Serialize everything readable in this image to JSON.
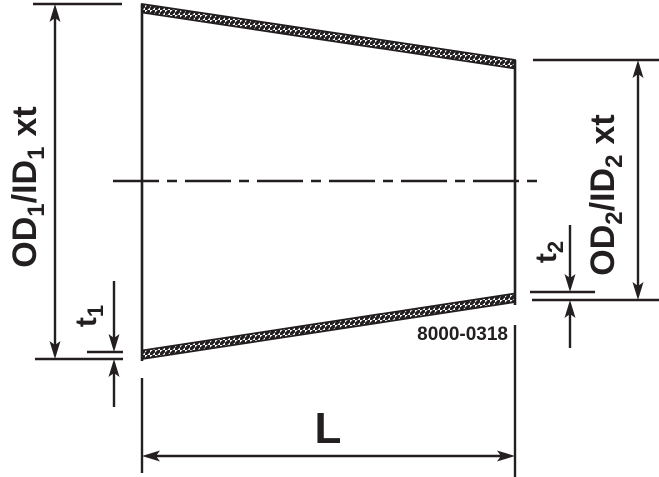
{
  "diagram": {
    "drawing_number": "8000-0318",
    "colors": {
      "line": "#231f20",
      "background": "#ffffff"
    },
    "labels": {
      "left_diameter": {
        "p1": "OD",
        "sub1": "1",
        "p2": "/ID",
        "sub2": "1",
        "p3": "xt"
      },
      "right_diameter": {
        "p1": "OD",
        "sub1": "2",
        "p2": "/ID",
        "sub2": "2",
        "p3": "xt"
      },
      "left_thickness": {
        "p1": "t",
        "sub1": "1"
      },
      "right_thickness": {
        "p1": "t",
        "sub1": "2"
      },
      "length": "L"
    }
  }
}
